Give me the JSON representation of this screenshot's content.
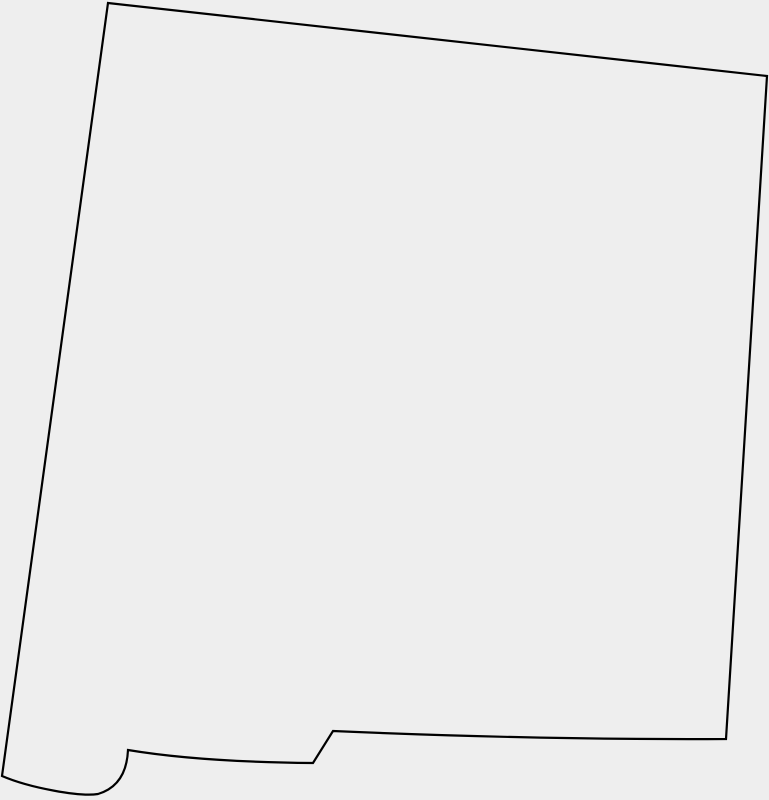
{
  "map": {
    "shape": "new-mexico-state-outline",
    "viewbox": "0 0 769 800",
    "outline_path": "M 108 3 L 767 76 L 726 739 Q 540 740 333 731 L 313 763 Q 200 762 128 750 C 127 772 118 788 98 794 C 80 797 30 788 2 776 Z",
    "stroke_width": "2.2",
    "colors": {
      "background": "#eeeeee",
      "fill": "#eeeeee",
      "stroke": "#000000"
    },
    "features": {
      "northwest_corner": "108,3",
      "northeast_corner": "767,76",
      "southeast_corner": "726,739",
      "rio_grande_step_top": "333,731",
      "rio_grande_step_bottom": "313,763",
      "bootheel_notch": "128,750",
      "southwest_corner": "2,776"
    }
  }
}
